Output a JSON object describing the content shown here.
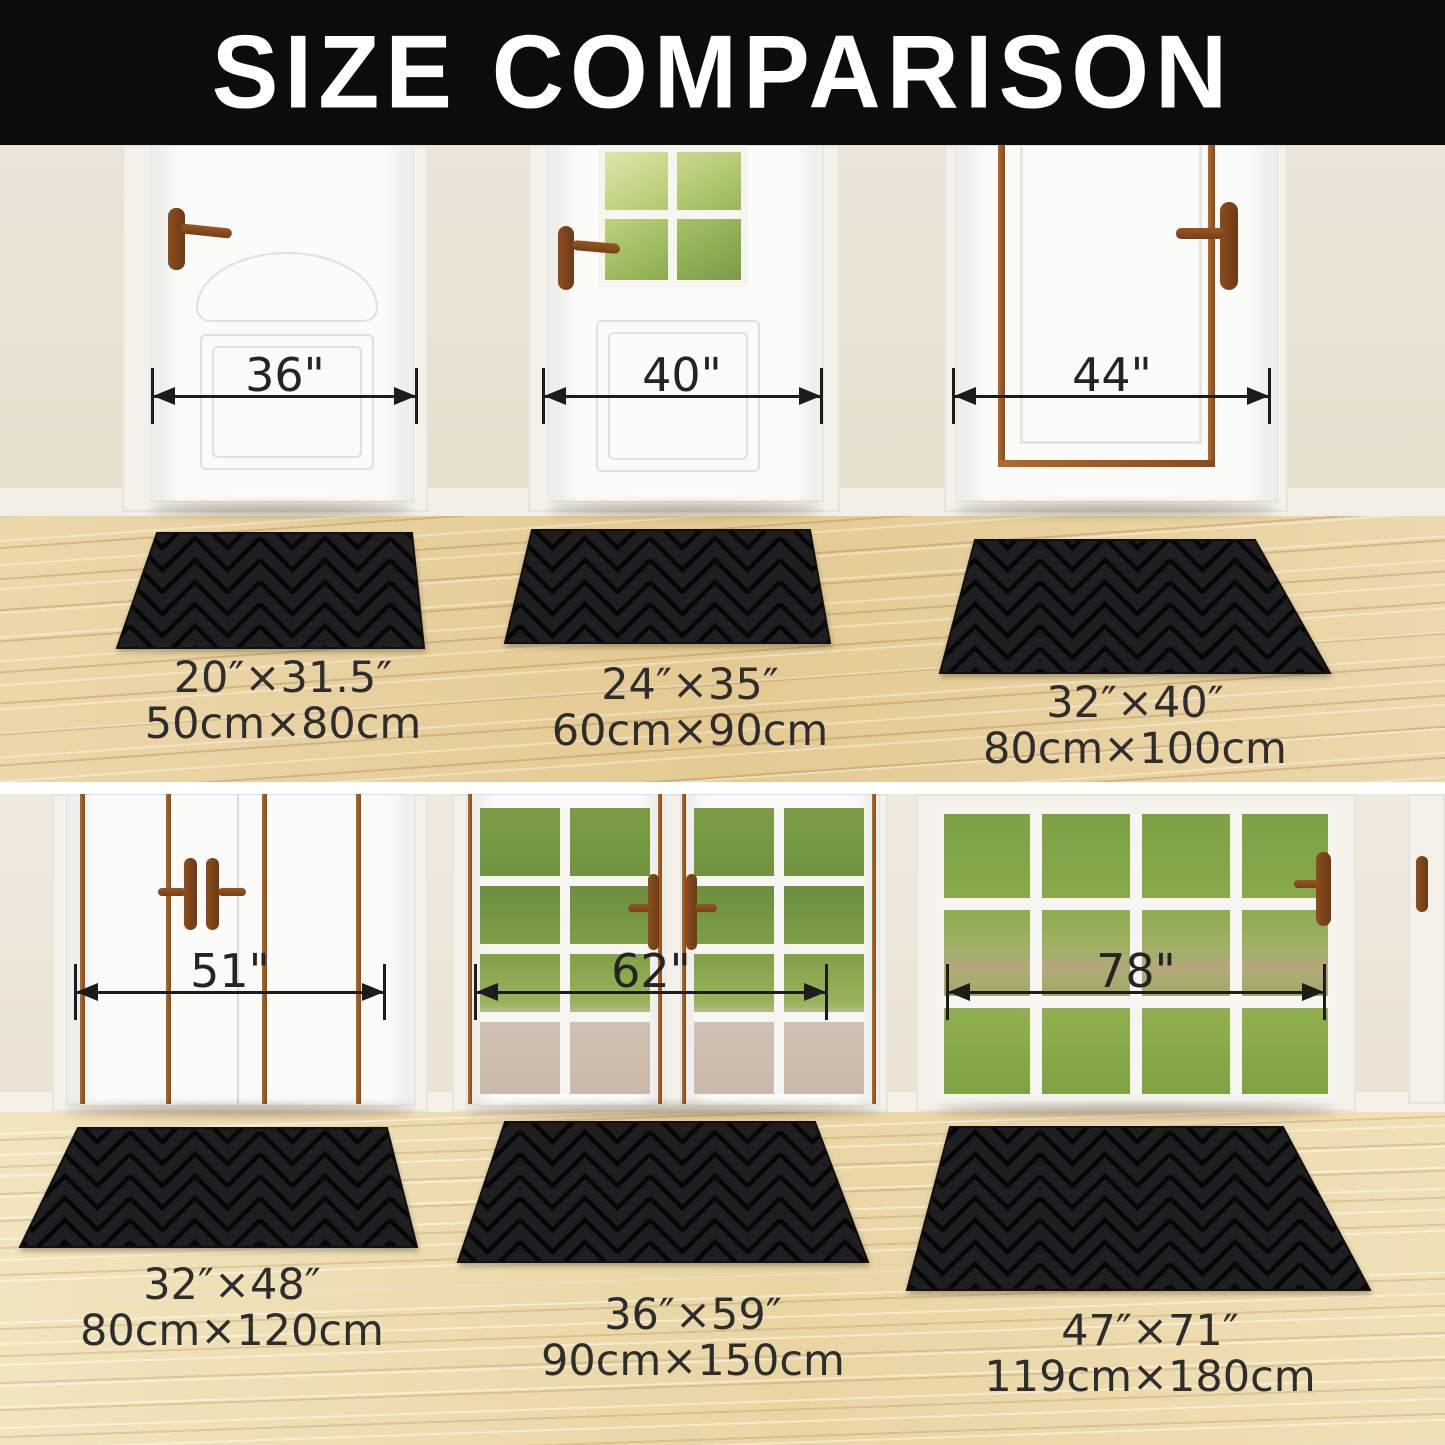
{
  "title": "SIZE COMPARISON",
  "sections": [
    {
      "name": "single-doors-row",
      "items": [
        {
          "door_width": "36\"",
          "size_inches": "20″×31.5″",
          "size_cm": "50cm×80cm"
        },
        {
          "door_width": "40\"",
          "size_inches": "24″×35″",
          "size_cm": "60cm×90cm"
        },
        {
          "door_width": "44\"",
          "size_inches": "32″×40″",
          "size_cm": "80cm×100cm"
        }
      ]
    },
    {
      "name": "double-doors-row",
      "items": [
        {
          "door_width": "51\"",
          "size_inches": "32″×48″",
          "size_cm": "80cm×120cm"
        },
        {
          "door_width": "62\"",
          "size_inches": "36″×59″",
          "size_cm": "90cm×150cm"
        },
        {
          "door_width": "78\"",
          "size_inches": "47″×71″",
          "size_cm": "119cm×180cm"
        }
      ]
    }
  ],
  "colors": {
    "header_bg": "#0c0c0c",
    "title_text": "#ffffff",
    "wall": "#ebe4d5",
    "floor_row1": "#e6cd9c",
    "floor_row2": "#eedcae",
    "mat": "#1e1e21",
    "door_trim_brown": "#8a4a1a",
    "measure_line": "#1c1c1c",
    "label_text": "#2d2d2d"
  }
}
